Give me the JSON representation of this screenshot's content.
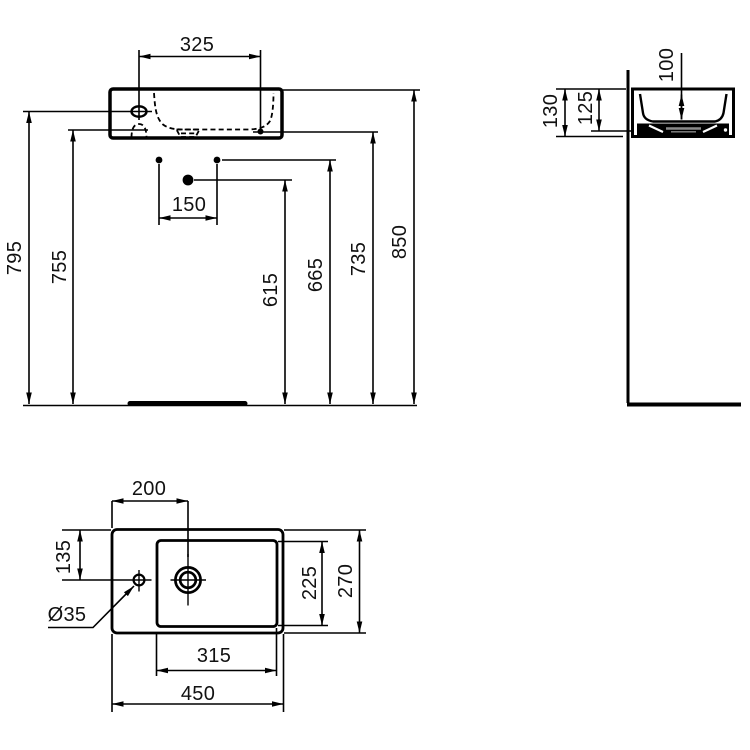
{
  "drawing_type": "washbasin technical dimension drawing",
  "colors": {
    "background": "#ffffff",
    "line": "#000000",
    "drain_accent": "#8a8a8a"
  },
  "front_view": {
    "dims": {
      "tap_hole_span": "325",
      "fixing_hole_spacing": "150",
      "tap_hole_height": "795",
      "underside_height": "755",
      "trap_height": "615",
      "fixing_holes_height": "665",
      "overflow_height": "735",
      "overall_height": "850"
    }
  },
  "side_view": {
    "dims": {
      "total_depth": "130",
      "mounting_depth": "125",
      "bowl_depth": "100"
    }
  },
  "plan_view": {
    "dims": {
      "tap_center_from_left": "200",
      "tap_center_from_back": "135",
      "tap_hole_diameter": "Ø35",
      "bowl_width": "315",
      "overall_width": "450",
      "bowl_front_to_back": "225",
      "overall_front_to_back": "270"
    }
  }
}
